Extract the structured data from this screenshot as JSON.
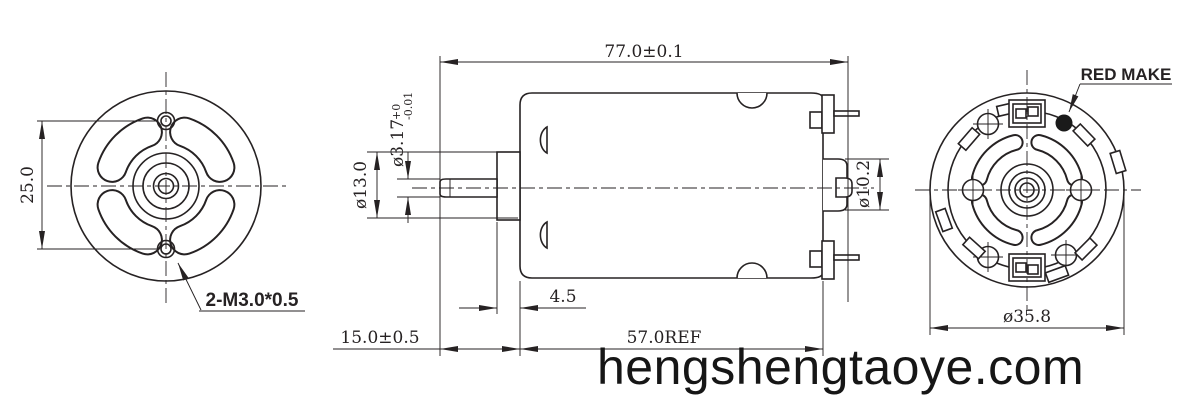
{
  "front_view": {
    "hole_spacing_dim": "25.0",
    "thread_callout": "2-M3.0*0.5"
  },
  "side_view": {
    "overall_length_dim": "77.0±0.1",
    "shaft_dia": "ø3.17",
    "shaft_tol_upper": "+0",
    "shaft_tol_lower": "-0.01",
    "bushing_dia": "ø13.0",
    "bushing_length_dim": "4.5",
    "front_section_dim": "15.0±0.5",
    "body_length_dim": "57.0REF",
    "endbell_boss_dia": "ø10.2"
  },
  "rear_view": {
    "mark_label": "RED MAKE",
    "body_dia": "ø35.8"
  },
  "watermark": "hengshengtaoye.com",
  "colors": {
    "line": "#262223",
    "background": "#ffffff",
    "mark_dot": "#1a1a1a"
  }
}
